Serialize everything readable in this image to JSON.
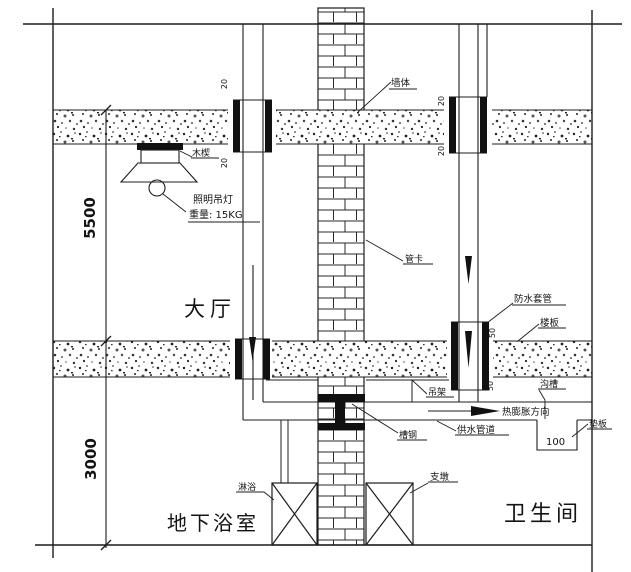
{
  "rooms": {
    "hall": "大厅",
    "basement_bath": "地下浴室",
    "toilet": "卫生间"
  },
  "labels": {
    "wall": "墙体",
    "wood_wedge": "木楔",
    "lamp": "照明吊灯",
    "lamp_weight": "重量: 15KG",
    "pipe_clamp": "管卡",
    "waterproof_sleeve": "防水套管",
    "floor_slab": "楼板",
    "hanger": "吊架",
    "groove": "沟槽",
    "expansion_direction": "热膨胀方向",
    "channel_steel": "槽钢",
    "supply_pipe": "供水管道",
    "pad_plate": "垫板",
    "shower": "淋浴",
    "support_pier": "支墩"
  },
  "dimensions": {
    "hall_height": "5500",
    "basement_height": "3000",
    "groove_depth": "100",
    "sleeve_protrusion": "20",
    "big_sleeve_protrusion": "50"
  },
  "colors": {
    "line": "#1c1c1c",
    "background": "#ffffff"
  }
}
